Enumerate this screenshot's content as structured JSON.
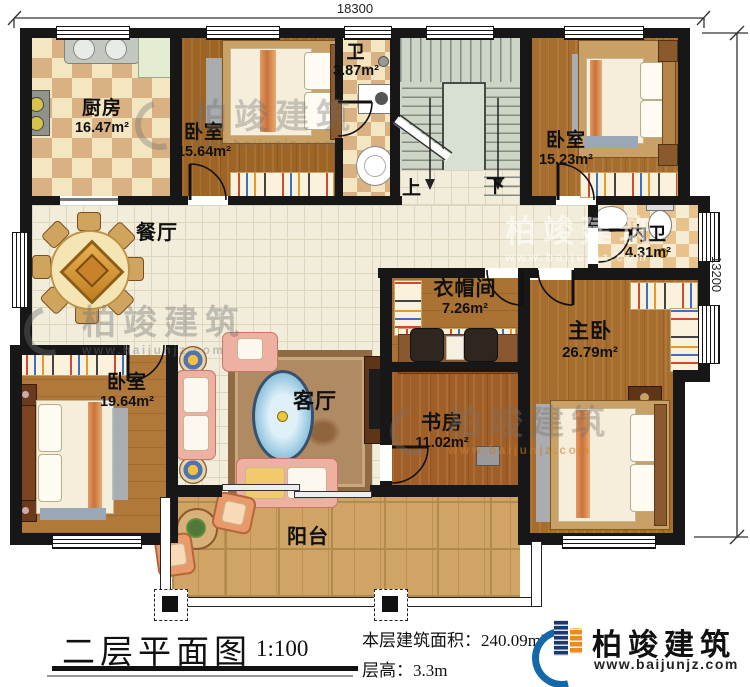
{
  "plan": {
    "dim_top": "18300",
    "dim_right": "13200",
    "rooms": {
      "kitchen": {
        "label": "厨房",
        "area": "16.47m²"
      },
      "bedroom_a": {
        "label": "卧室",
        "area": "15.64m²"
      },
      "bath": {
        "label": "卫",
        "area": "3.87m²"
      },
      "bedroom_b": {
        "label": "卧室",
        "area": "15.23m²"
      },
      "dining": {
        "label": "餐厅"
      },
      "inner_bath": {
        "label": "内卫",
        "area": "4.31m²"
      },
      "cloakroom": {
        "label": "衣帽间",
        "area": "7.26m²"
      },
      "master": {
        "label": "主卧",
        "area": "26.79m²"
      },
      "bedroom_c": {
        "label": "卧室",
        "area": "19.64m²"
      },
      "living": {
        "label": "客厅"
      },
      "study": {
        "label": "书房",
        "area": "11.02m²"
      },
      "balcony": {
        "label": "阳台"
      }
    },
    "stairs": {
      "up": "上",
      "down": "下"
    }
  },
  "footer": {
    "title": "二层平面图",
    "scale": "1:100",
    "area_line": "本层建筑面积：240.09m²",
    "height_line": "层高：3.3m"
  },
  "brand": {
    "name": "柏竣建筑",
    "site": "www.baijunjz.com"
  },
  "watermark": {
    "name": "柏竣建筑",
    "site": "www.baijunjz.com"
  }
}
